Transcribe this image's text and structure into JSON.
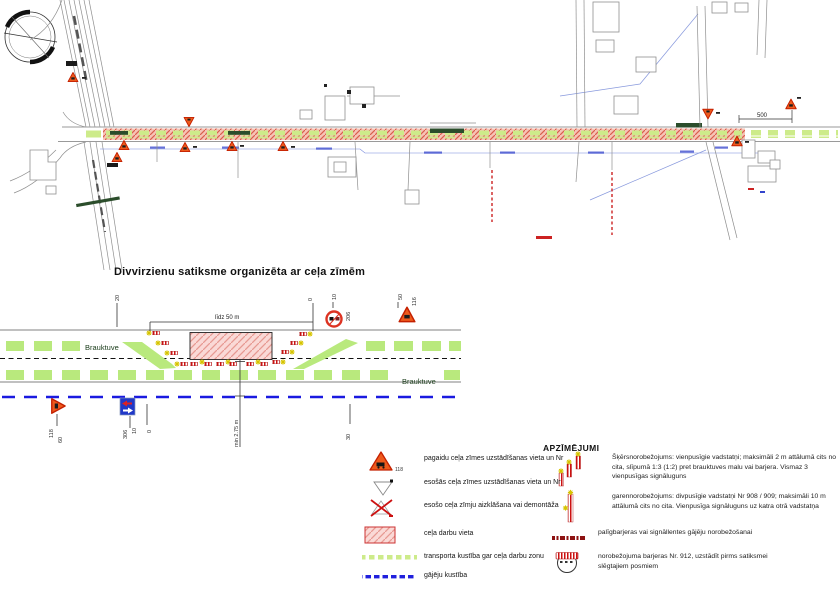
{
  "map": {
    "dimension_label": "500"
  },
  "diagram": {
    "title": "Divvirzienu satiksme organizēta ar ceļa zīmēm",
    "lane_top": "Brauktuve",
    "lane_bottom": "Brauktuve",
    "width_dimension": "līdz 50 m",
    "height_dimension": "min 2.75 m",
    "ticks": {
      "left": "20",
      "zero_top": "0",
      "ten_top": "10",
      "fifty_top": "50",
      "sixty": "60",
      "ten_bottom": "10",
      "zero_bottom": "0",
      "thirty": "30"
    },
    "signs": {
      "round_sign_nr": "206",
      "triangle_sign_nr": "116",
      "roadworks_sign_nr": "118",
      "priority_sign_nr": "306"
    }
  },
  "legend": {
    "title": "APZĪMĒJUMI",
    "left": [
      {
        "icon": "temporary-sign-triangle",
        "number": "118",
        "label": "pagaidu ceļa zīmes uzstādīšanas vieta un Nr"
      },
      {
        "icon": "existing-sign-triangle",
        "label": "esošās ceļa zīmes uzstādīšanas vieta un Nr"
      },
      {
        "icon": "crossed-out-sign",
        "label": "esošo ceļa zīmju aizklāšana vai demontāža"
      },
      {
        "icon": "hatched-work-area",
        "label": "ceļa darbu vieta"
      },
      {
        "icon": "green-dashed-line",
        "label": "transporta kustība gar ceļa darbu zonu"
      },
      {
        "icon": "blue-dashed-line",
        "label": "gājēju kustība"
      }
    ],
    "right": [
      {
        "icon": "guide-posts-cluster",
        "label": "Šķērsnorobežojums: vienpusīgie vadstatņi; maksimāli 2 m attālumā cits no cita, slīpumā 1:3 (1:2) pret brauktuves malu vai barjera. Vismaz 3 vienpusīgas signāluguns"
      },
      {
        "icon": "guide-post-single",
        "label": "garennorobežojums: divpusīgie vadstatņi Nr 908 / 909; maksimāli 10 m attālumā cits no cita. Vienpusīga signāluguns uz katra otrā vadstatņa"
      },
      {
        "icon": "maroon-dashed-line",
        "label": "palīgbarjeras vai signāllentes gājēju norobežošanai"
      },
      {
        "icon": "barrier-912",
        "label": "norobežojuma barjeras Nr. 912, uzstādīt pirms satiksmei slēgtajiem posmiem"
      }
    ]
  },
  "colors": {
    "sign_orange": "#ee5a1c",
    "work_zone_pink": "#fad9d6",
    "corridor_hatch": "#d95f4d",
    "traffic_green": "#c3ea7d",
    "pedestrian_blue": "#1a1ae0",
    "maroon": "#8d1212",
    "star_yellow": "#d6c400"
  }
}
